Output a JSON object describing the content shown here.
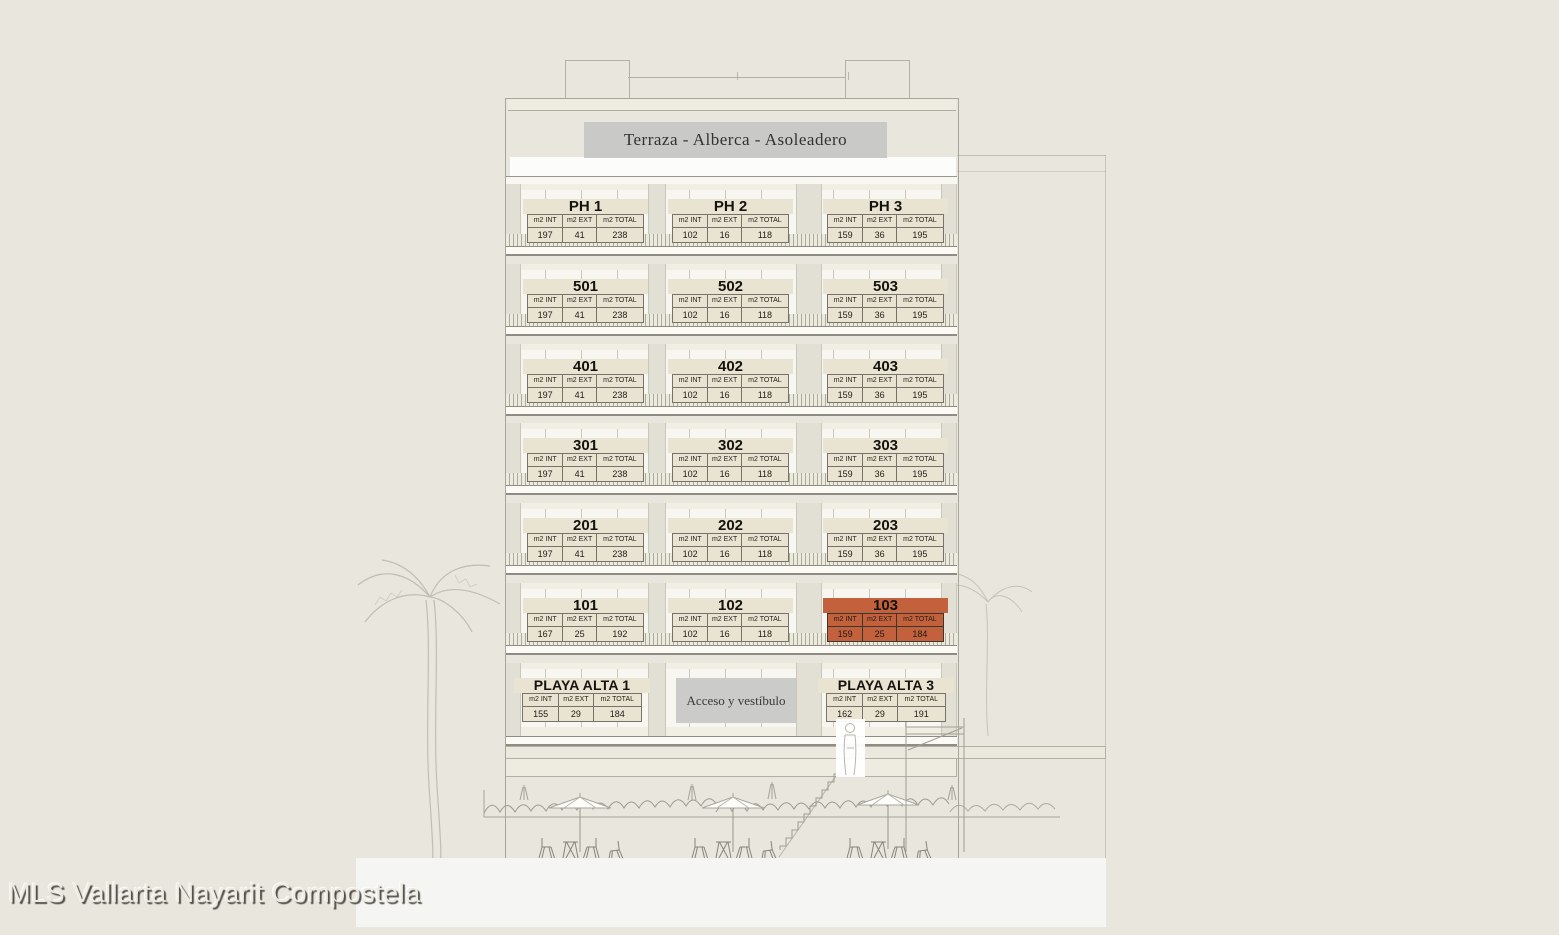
{
  "watermark": "MLS Vallarta Nayarit Compostela",
  "roof_banner": "Terraza - Alberca - Asoleadero",
  "table_headers": [
    "m2 INT",
    "m2 EXT",
    "m2 TOTAL"
  ],
  "colors": {
    "background": "#e8e6dd",
    "card": "#e9e4d2",
    "highlight": "#c2613c",
    "banner": "#c9c9c8",
    "lobby": "#cbcbca",
    "footer": "#f5f5f4"
  },
  "floors": [
    {
      "level": "PH",
      "units": [
        {
          "id": "PH 1",
          "values": [
            "197",
            "41",
            "238"
          ]
        },
        {
          "id": "PH 2",
          "values": [
            "102",
            "16",
            "118"
          ]
        },
        {
          "id": "PH 3",
          "values": [
            "159",
            "36",
            "195"
          ]
        }
      ]
    },
    {
      "level": "5",
      "units": [
        {
          "id": "501",
          "values": [
            "197",
            "41",
            "238"
          ]
        },
        {
          "id": "502",
          "values": [
            "102",
            "16",
            "118"
          ]
        },
        {
          "id": "503",
          "values": [
            "159",
            "36",
            "195"
          ]
        }
      ]
    },
    {
      "level": "4",
      "units": [
        {
          "id": "401",
          "values": [
            "197",
            "41",
            "238"
          ]
        },
        {
          "id": "402",
          "values": [
            "102",
            "16",
            "118"
          ]
        },
        {
          "id": "403",
          "values": [
            "159",
            "36",
            "195"
          ]
        }
      ]
    },
    {
      "level": "3",
      "units": [
        {
          "id": "301",
          "values": [
            "197",
            "41",
            "238"
          ]
        },
        {
          "id": "302",
          "values": [
            "102",
            "16",
            "118"
          ]
        },
        {
          "id": "303",
          "values": [
            "159",
            "36",
            "195"
          ]
        }
      ]
    },
    {
      "level": "2",
      "units": [
        {
          "id": "201",
          "values": [
            "197",
            "41",
            "238"
          ]
        },
        {
          "id": "202",
          "values": [
            "102",
            "16",
            "118"
          ]
        },
        {
          "id": "203",
          "values": [
            "159",
            "36",
            "195"
          ]
        }
      ]
    },
    {
      "level": "1",
      "units": [
        {
          "id": "101",
          "values": [
            "167",
            "25",
            "192"
          ]
        },
        {
          "id": "102",
          "values": [
            "102",
            "16",
            "118"
          ]
        },
        {
          "id": "103",
          "values": [
            "159",
            "25",
            "184"
          ],
          "highlighted": true
        }
      ]
    }
  ],
  "ground_floor": {
    "lobby_label": "Acceso y vestíbulo",
    "units": [
      {
        "id": "PLAYA ALTA 1",
        "values": [
          "155",
          "29",
          "184"
        ]
      },
      {
        "id": "PLAYA ALTA 3",
        "values": [
          "162",
          "29",
          "191"
        ]
      }
    ]
  }
}
